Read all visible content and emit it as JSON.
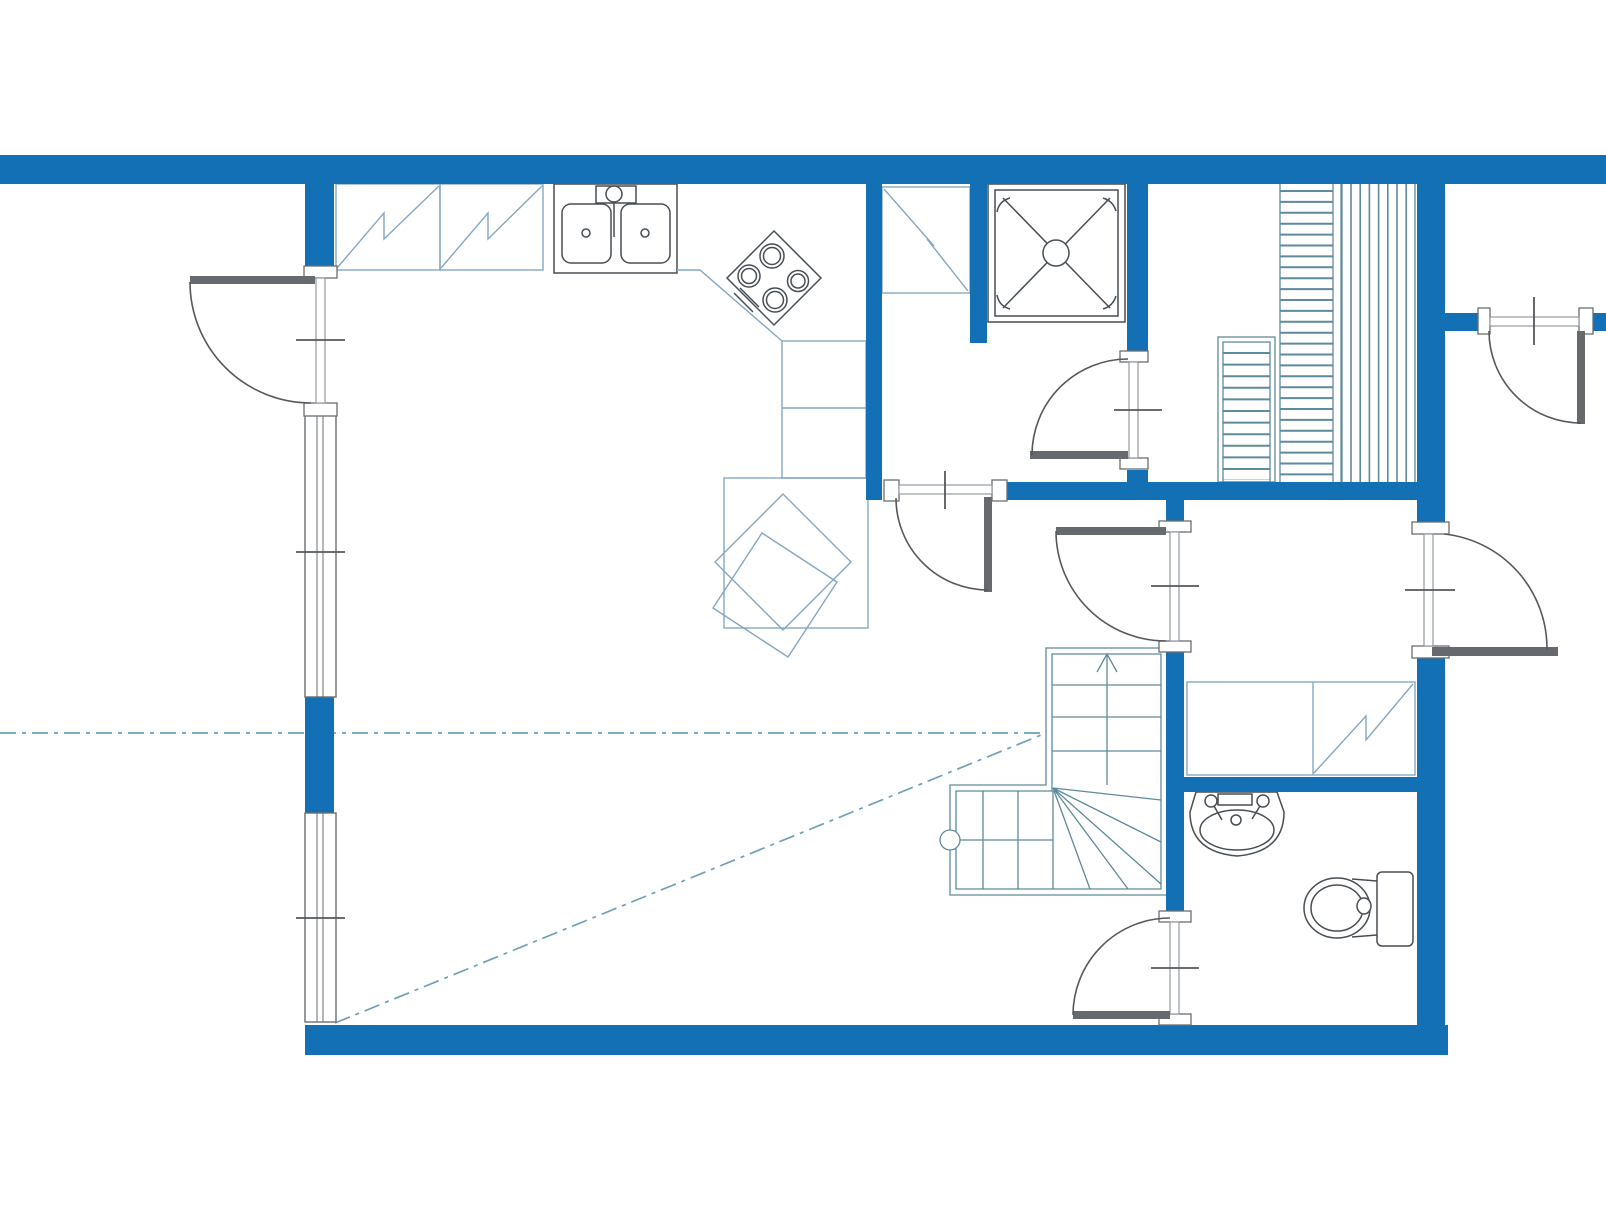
{
  "drawing": {
    "kind": "architectural-floor-plan",
    "text_labels": [],
    "rooms": [
      {
        "name": "kitchen-living-room"
      },
      {
        "name": "washroom-with-shower"
      },
      {
        "name": "stairwell"
      },
      {
        "name": "stair-hall"
      },
      {
        "name": "vestibule"
      },
      {
        "name": "bathroom"
      }
    ],
    "fixtures": [
      {
        "name": "kitchen-counter-reservation",
        "count": 2
      },
      {
        "name": "kitchen-double-sink",
        "count": 1
      },
      {
        "name": "cooktop-four-burners",
        "count": 1
      },
      {
        "name": "dining-table-group",
        "count": 1
      },
      {
        "name": "tall-cabinet-reservation",
        "count": 1
      },
      {
        "name": "shower",
        "count": 1
      },
      {
        "name": "closet-reservation",
        "count": 2
      },
      {
        "name": "washbasin",
        "count": 1
      },
      {
        "name": "toilet",
        "count": 1
      },
      {
        "name": "l-shaped-stair",
        "count": 1
      },
      {
        "name": "straight-stair-flight",
        "count": 2
      }
    ],
    "doors": {
      "count": 7,
      "style": "quarter-circle-swing"
    },
    "windows": {
      "count": 2,
      "wall": "west"
    }
  },
  "colors": {
    "background": "#ffffff",
    "wall": "#1370b4",
    "furniture_line": "#84a7c2",
    "stair_line": "#5d8a9c",
    "fixture_line": "#474e54",
    "door_line": "#54585c",
    "door_leaf": "#66696d",
    "frame_stroke": "#6a6e72",
    "threshold_stroke": "#8d9296",
    "dash_line": "#6fa0b8"
  }
}
